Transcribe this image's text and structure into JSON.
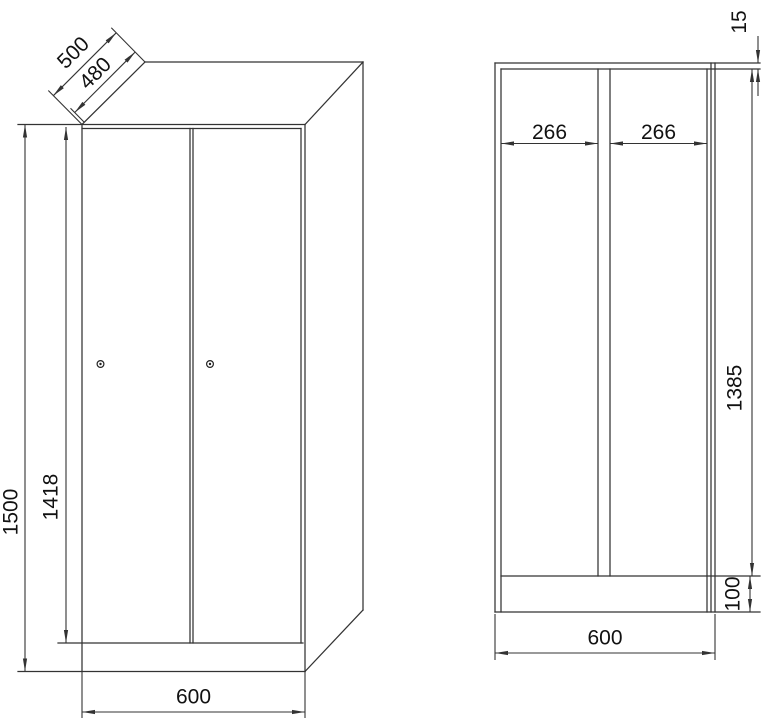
{
  "drawing_type": "locker cabinet dimension drawing, two views",
  "front_view": {
    "depth_total_mm": "500",
    "depth_body_mm": "480",
    "height_total_mm": "1500",
    "door_height_mm": "1418",
    "width_mm": "600"
  },
  "section_view": {
    "top_panel_mm": "15",
    "compartment_width_left_mm": "266",
    "compartment_width_right_mm": "266",
    "interior_height_mm": "1385",
    "plinth_height_mm": "100",
    "width_mm": "600"
  },
  "colors": {
    "line": "#333333",
    "text": "#111111",
    "background": "#ffffff"
  }
}
